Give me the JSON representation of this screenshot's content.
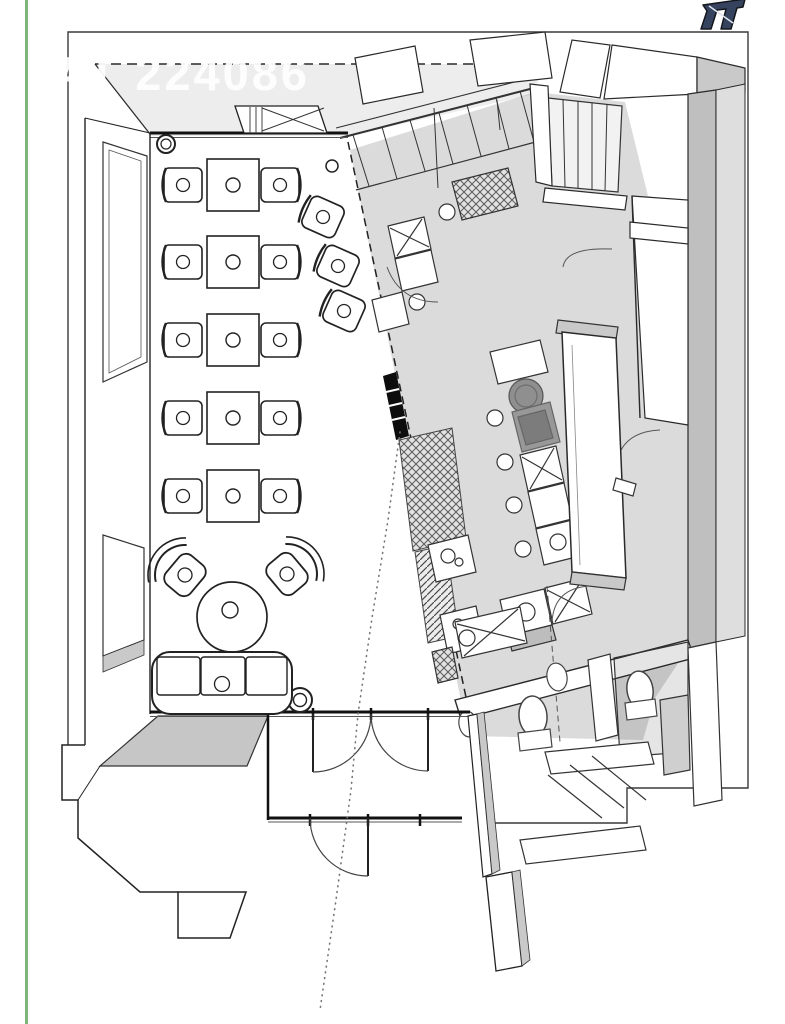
{
  "watermark": {
    "text": "AT 224086"
  },
  "page": {
    "background": "#ffffff",
    "margin_rule_color": "#7db57d"
  },
  "logo": {
    "name": "site-logo",
    "color": "#35435f"
  },
  "plan": {
    "style": "3d-axonometric-floor-plan",
    "line_color": "#1e1e1e",
    "wall_top_color": "#c9c9c9",
    "kitchen_tint": "rgba(0,0,0,0.14)",
    "light_band_color": "#ededed",
    "rooms": [
      "dining-area",
      "kitchen",
      "stairs",
      "restrooms",
      "entry-vestibule",
      "lounge"
    ],
    "furniture_counts": {
      "square_tables": 5,
      "side_chairs": 10,
      "bar_chairs": 3,
      "lounge_chairs": 2,
      "sofa_seats": 3,
      "round_tables": 1,
      "toilets": 2,
      "wall_cabinets_x": 3
    }
  }
}
